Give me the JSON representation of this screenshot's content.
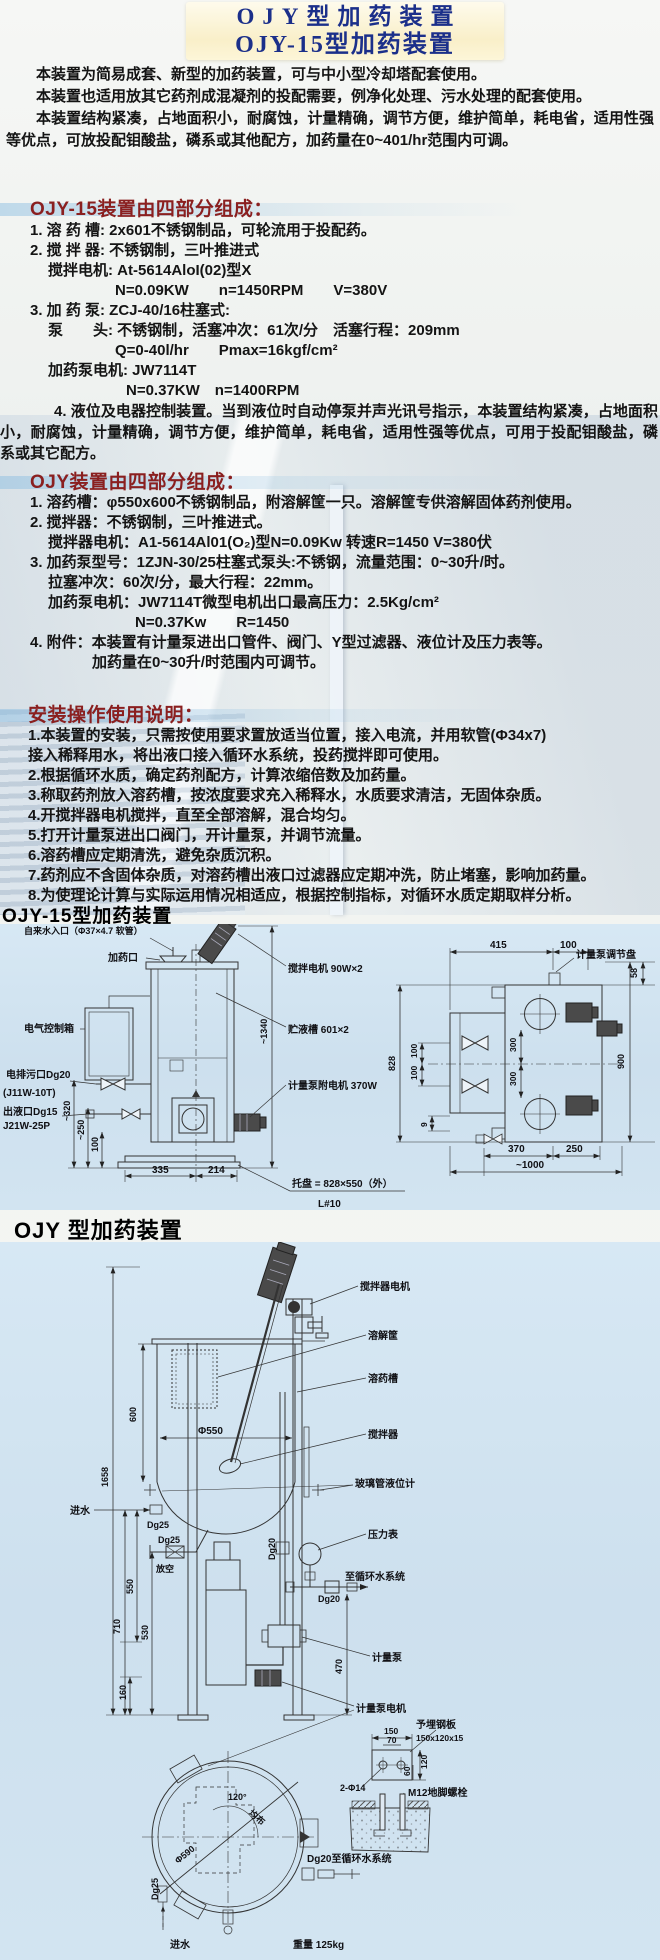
{
  "colors": {
    "title_text": "#1b2f8a",
    "title_panel": "#f9efc9",
    "section_heading": "#8a1f1f",
    "diagram_background": "#cfe2ef",
    "body_text": "#141414"
  },
  "title": {
    "line1": "OJY型加药装置",
    "line2": "OJY-15型加药装置"
  },
  "intro": {
    "p1": "本装置为简易成套、新型的加药装置，可与中小型冷却塔配套使用。",
    "p2": "本装置也适用放其它药剂成混凝剂的投配需要，例净化处理、污水处理的配套使用。",
    "p3": "本装置结构紧凑，占地面积小，耐腐蚀，计量精确，调节方便，维护简单，耗电省，适用性强等优点，可放投配钼酸盐，磷系或其他配方，加药量在0~401/hr范围内可调。"
  },
  "sec_ojy15": {
    "heading": "OJY-15装置由四部分组成：",
    "lines": [
      "1. 溶 药 槽: 2x601不锈钢制品，可轮流用于投配药。",
      "2. 搅 拌 器: 不锈钢制，三叶推进式",
      "搅拌电机: At-5614AloI(02)型X",
      "N=0.09KW　　n=1450RPM　　V=380V",
      "3. 加 药 泵: ZCJ-40/16柱塞式:",
      "泵　　头: 不锈钢制，活塞冲次：61次/分　活塞行程：209mm",
      "Q=0-40l/hr　　Pmax=16kgf/cm²",
      "加药泵电机: JW7114T",
      "N=0.37KW　n=1400RPM",
      "4. 液位及电器控制装置。当到液位时自动停泵并声光讯号指示，本装置结构紧凑，占地面积小，耐腐蚀，计量精确，调节方便，维护简单，耗电省，适用性强等优点，可用于投配钼酸盐，磷系或其它配方。"
    ]
  },
  "sec_ojy": {
    "heading": "OJY装置由四部分组成：",
    "lines": [
      "1. 溶药槽：φ550x600不锈钢制品，附溶解筐一只。溶解筐专供溶解固体药剂使用。",
      "2. 搅拌器：不锈钢制，三叶推进式。",
      "搅拌器电机：A1-5614Al01(O₂)型N=0.09Kw 转速R=1450 V=380伏",
      "3. 加药泵型号：1ZJN-30/25柱塞式泵头:不锈钢，流量范围：0~30升/时。",
      "拉塞冲次：60次/分，最大行程：22mm。",
      "加药泵电机：JW7114T微型电机出口最高压力：2.5Kg/cm²",
      "N=0.37Kw　　R=1450",
      "4. 附件：本装置有计量泵进出口管件、阀门、Y型过滤器、液位计及压力表等。",
      "加药量在0~30升/时范围内可调节。"
    ]
  },
  "sec_install": {
    "heading": "安装操作使用说明：",
    "lines": [
      "1.本装置的安装，只需按使用要求置放适当位置，接入电流，并用软管(Φ34x7)",
      "接入稀释用水，将出液口接入循环水系统，投药搅拌即可使用。",
      "2.根据循环水质，确定药剂配方，计算浓缩倍数及加药量。",
      "3.称取药剂放入溶药槽，按浓度要求充入稀释水，水质要求清洁，无固体杂质。",
      "4.开搅拌器电机搅拌，直至全部溶解，混合均匀。",
      "5.打开计量泵进出口阀门，开计量泵，并调节流量。",
      "6.溶药槽应定期清洗，避免杂质沉积。",
      "7.药剂应不含固体杂质，对溶药槽出液口过滤器应定期冲洗，防止堵塞，影响加药量。",
      "8.为使理论计算与实际运用情况相适应，根据控制指标，对循环水质定期取样分析。"
    ]
  },
  "diagram1": {
    "heading": "OJY-15型加药装置",
    "labels": {
      "water_inlet": "自来水入口（Φ37×4.7 软管）",
      "dosing_port": "加药口",
      "control_box": "电气控制箱",
      "drain_port": "电排污口Dg20",
      "drain_model": "(J11W-10T)",
      "outlet_port": "出液口Dg15",
      "outlet_model": "J21W-25P",
      "mixer_motor": "搅拌电机 90W×2",
      "storage_tank": "贮液槽 601×2",
      "pump_motor": "计量泵附电机 370W",
      "tray": "托盘 = 828×550（外）",
      "angle_steel": "L#10",
      "adjust_plate": "计量泵调节盘"
    },
    "dims": {
      "h320": "~320",
      "h250": "~250",
      "h100": "100",
      "h1340": "~1340",
      "w335": "335",
      "w214": "214",
      "t415": "415",
      "t100": "100",
      "r58": "58",
      "r900": "900",
      "l828": "828",
      "l100a": "100",
      "l100b": "100",
      "m300a": "300",
      "m300b": "300",
      "b9": "9",
      "b370": "370",
      "b250": "250",
      "b1000": "~1000"
    }
  },
  "diagram2": {
    "heading": "OJY 型加药装置",
    "labels": {
      "mixer_motor": "搅拌器电机",
      "basket": "溶解筐",
      "tank": "溶药槽",
      "mixer": "搅拌器",
      "level_gauge": "玻璃管液位计",
      "pressure_gauge": "压力表",
      "to_system": "至循环水系统",
      "pump": "计量泵",
      "pump_motor": "计量泵电机",
      "embed_plate": "予埋钢板",
      "plate_size": "150x120x15",
      "bolt_holes": "2-Φ14",
      "anchor_bolt": "M12地脚螺栓",
      "dg20_system": "Dg20至循环水系统",
      "inlet_top": "进水",
      "inlet_bottom": "进水",
      "dg25_top": "Dg25",
      "dg25_mid": "Dg25",
      "dg25_plan": "Dg25",
      "vent": "放空",
      "dg20_pipe": "Dg20",
      "dg20_valve": "Dg20",
      "weight": "重量 125kg",
      "phi590": "Φ590",
      "deg120": "120°",
      "evenly": "均布"
    },
    "dims": {
      "v600": "600",
      "phi550": "Φ550",
      "v1658": "1658",
      "v710": "710",
      "v550": "550",
      "v530": "530",
      "v160": "160",
      "v470": "470",
      "a150": "150",
      "a70": "70",
      "a120": "120",
      "a60": "60"
    }
  }
}
